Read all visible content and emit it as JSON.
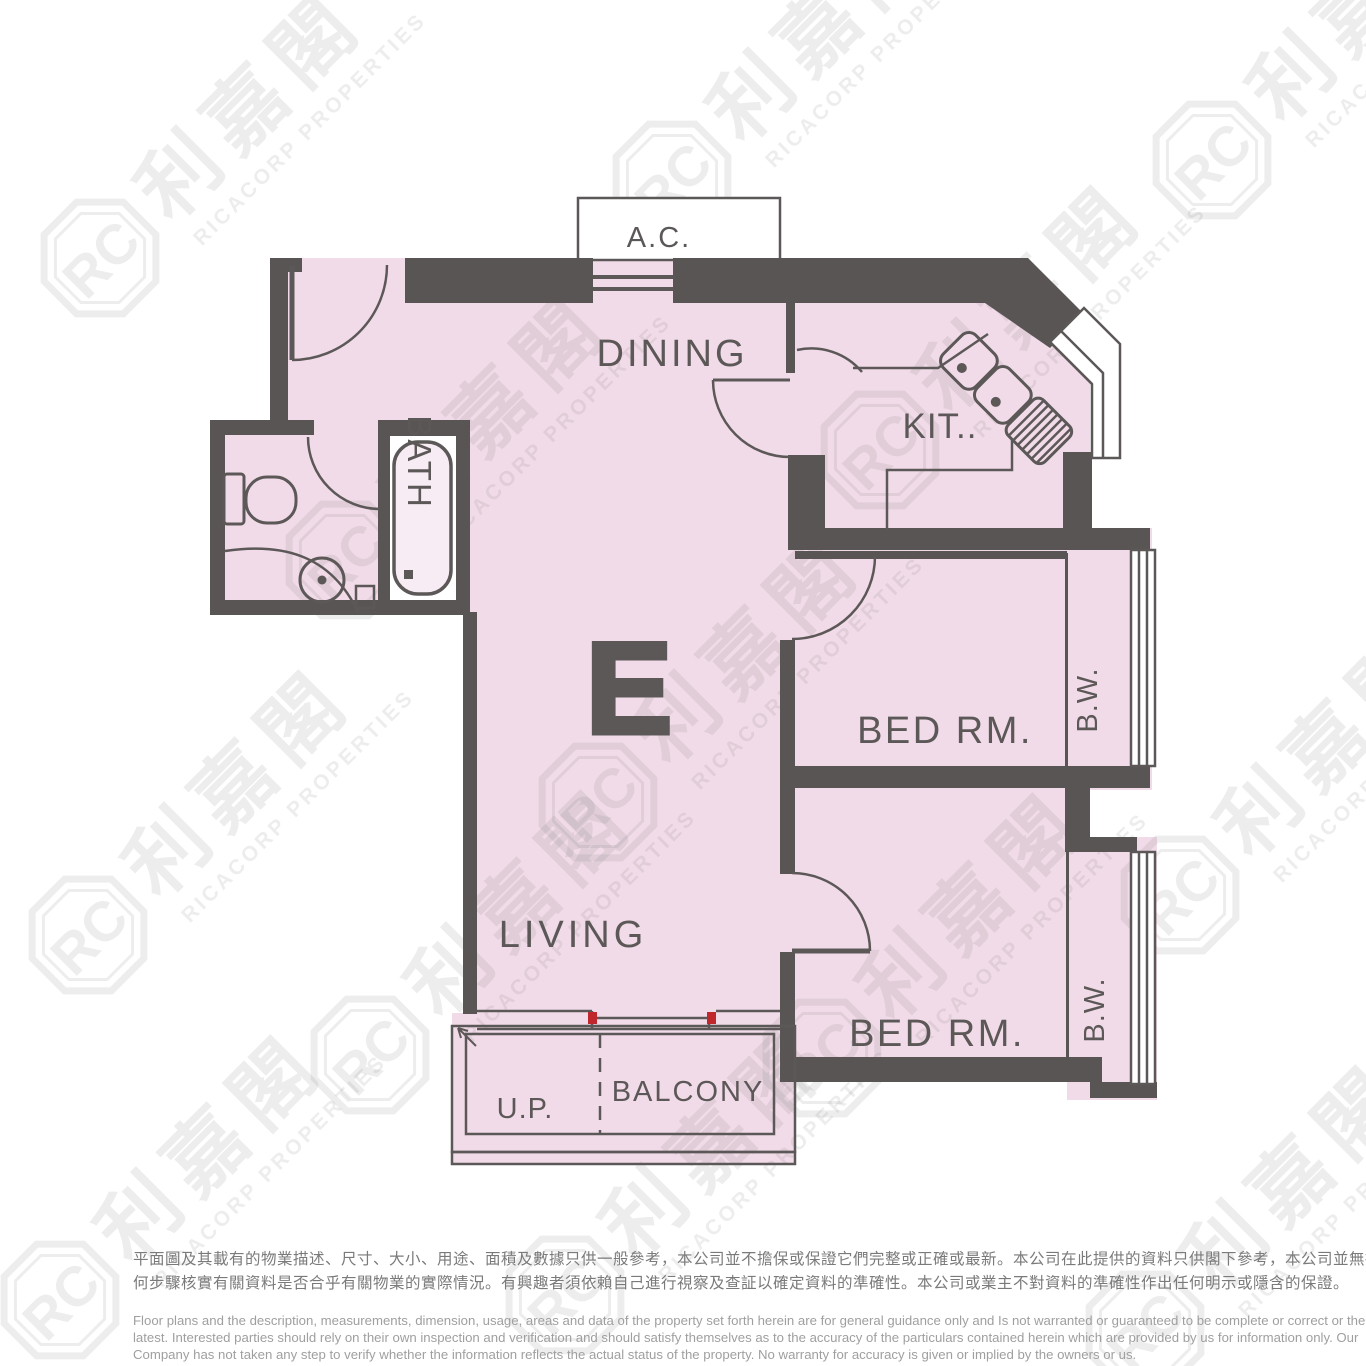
{
  "plan": {
    "unit_letter": "E",
    "colors": {
      "wall": "#5a5555",
      "floor": "#f1dbe8",
      "line": "#5d5858",
      "window_fill": "#ffffff",
      "door_marker_red": "#c0272d"
    },
    "labels": {
      "ac": "A.C.",
      "dining": "DINING",
      "kitchen": "KIT..",
      "bath": "BATH",
      "bed_room_1": "BED RM.",
      "bay_window_1": "B.W.",
      "living": "LIVING",
      "bed_room_2": "BED RM.",
      "bay_window_2": "B.W.",
      "utility_platform": "U.P.",
      "balcony": "BALCONY"
    }
  },
  "watermark": {
    "monogram": "RC",
    "chinese": "利嘉閣",
    "english": "RICACORP PROPERTIES"
  },
  "disclaimer": {
    "zh": [
      "平面圖及其載有的物業描述、尺寸、大小、用途、面積及數據只供一般參考，本公司並不擔保或保證它們完整或正確或最新。本公司在此提供的資料只供閣下參考，本公司並無採取任",
      "何步驟核實有關資料是否合乎有關物業的實際情況。有興趣者須依賴自己進行視察及查証以確定資料的準確性。本公司或業主不對資料的準確性作出任何明示或隱含的保證。"
    ],
    "en": [
      "Floor plans and the description, measurements, dimension, usage, areas and data of the property set forth herein are for general guidance only and Is not warranted or guaranteed to be complete or correct or the",
      "latest. Interested parties should rely on their own inspection and verification and should satisfy themselves as to the accuracy of the particulars contained herein which are provided by us for information only.  Our",
      "Company has not taken any step to verify whether the information reflects the actual status of the property.  No warranty for accuracy is given or implied by the owners or us."
    ]
  }
}
